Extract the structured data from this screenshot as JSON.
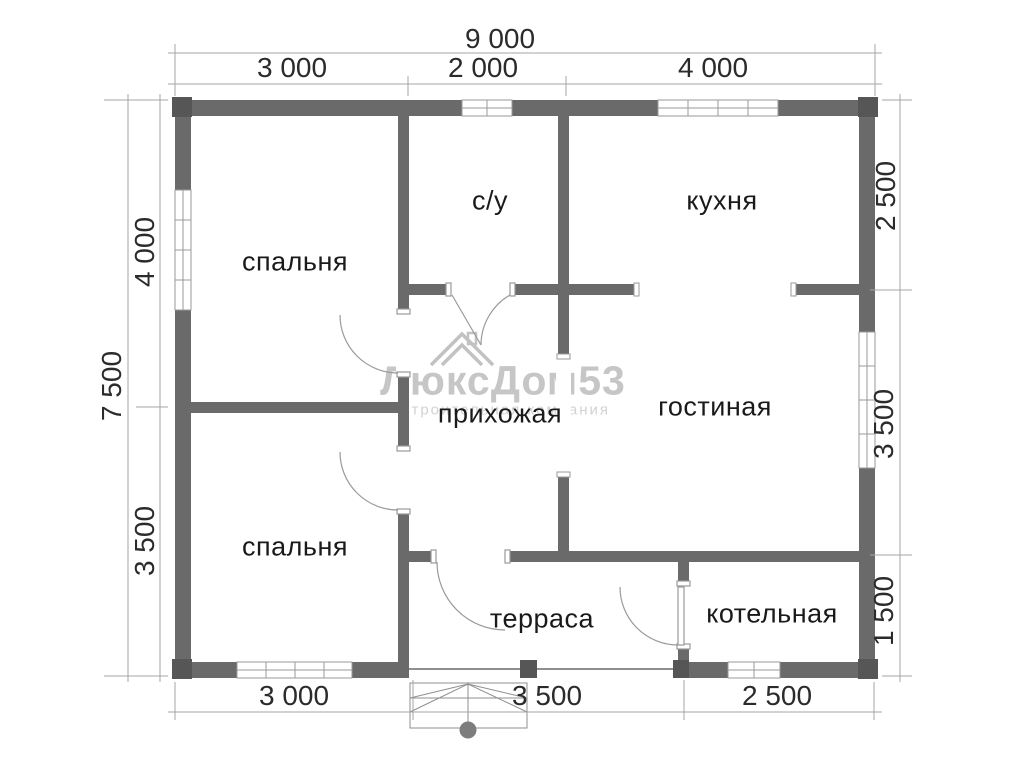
{
  "watermark": {
    "title": "ЛюксДом53",
    "subtitle": "строительная компания"
  },
  "rooms": [
    {
      "id": "bedroom-1",
      "label": "спальня"
    },
    {
      "id": "bathroom",
      "label": "с/у"
    },
    {
      "id": "kitchen",
      "label": "кухня"
    },
    {
      "id": "hallway",
      "label": "прихожая"
    },
    {
      "id": "living-room",
      "label": "гостиная"
    },
    {
      "id": "bedroom-2",
      "label": "спальня"
    },
    {
      "id": "terrace",
      "label": "терраса"
    },
    {
      "id": "boiler-room",
      "label": "котельная"
    }
  ],
  "dimensions": {
    "top": {
      "total": "9 000",
      "segments": [
        "3 000",
        "2 000",
        "4 000"
      ]
    },
    "left": {
      "total": "7 500",
      "segments": [
        "4 000",
        "3 500"
      ]
    },
    "right": {
      "segments": [
        "2 500",
        "3 500",
        "1 500"
      ]
    },
    "bottom": {
      "segments": [
        "3 000",
        "3 500",
        "2 500"
      ]
    }
  },
  "colors": {
    "wall": "#6a6a6a",
    "corner": "#565656",
    "thin_line": "#9a9a9a",
    "label_text": "#1a1a1a",
    "watermark": "#c6c6c6"
  }
}
